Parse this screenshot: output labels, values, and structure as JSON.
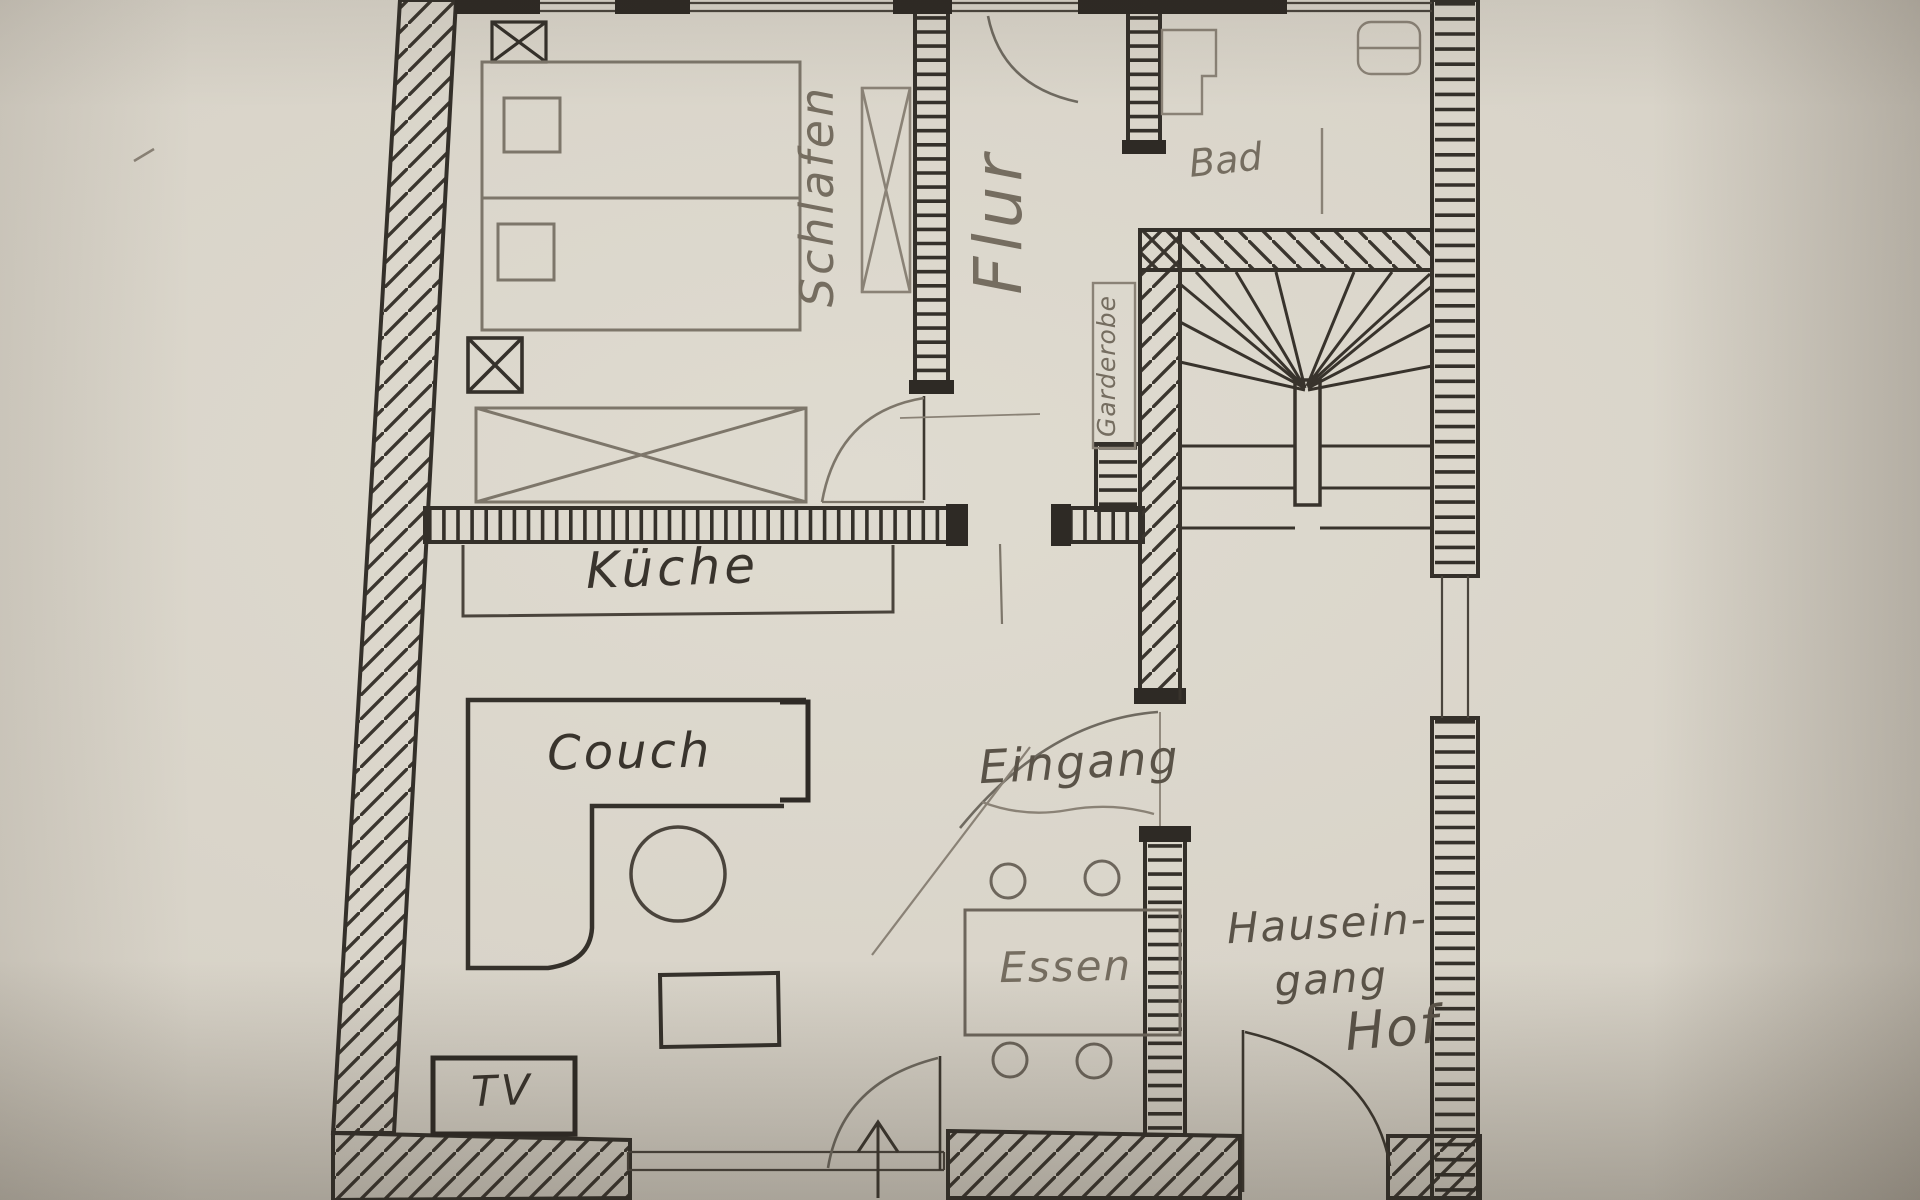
{
  "document": {
    "kind": "hand-drawn apartment floor plan sketch",
    "medium": "ink and pencil on photographed paper"
  },
  "colors": {
    "paper": "#d8d3c8",
    "ink": "#34302a",
    "pencil": "#7d766a",
    "pencil_text": "#756d60"
  },
  "rooms": {
    "schlafen": {
      "label": "Schlafen"
    },
    "flur": {
      "label": "Flur"
    },
    "bad": {
      "label": "Bad"
    },
    "garderobe": {
      "label": "Garderobe"
    },
    "kueche": {
      "label": "Küche"
    },
    "eingang": {
      "label": "Eingang"
    },
    "essen": {
      "label": "Essen"
    },
    "hauseingang": {
      "line1": "Hausein-",
      "line2": "gang"
    },
    "hof": {
      "label": "Hof"
    }
  },
  "furniture": {
    "couch": {
      "label": "Couch"
    },
    "tv": {
      "label": "TV"
    }
  }
}
